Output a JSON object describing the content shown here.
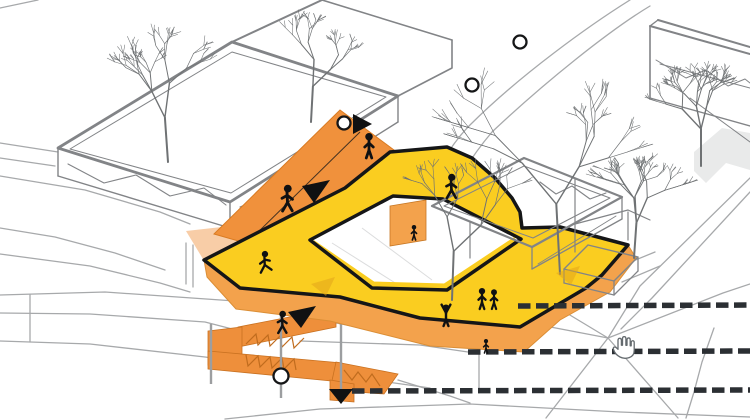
{
  "scene": {
    "type": "axonometric-architecture-diagram",
    "background": "#FFFFFF",
    "colors": {
      "platform_yellow": "#FACD20",
      "ramp_orange": "#F0913C",
      "apron_orange": "#F3A24C",
      "stair_orange": "#EE8F3B",
      "stair_detail": "#C06C1E",
      "outline_black": "#151617",
      "wireframe_gray": "#828487",
      "terrain_gray": "#A7A9AB",
      "tree_gray": "#6F7274",
      "dashed_line": "#2B2F33",
      "watermark_gray": "#E9EAEA",
      "figure_black": "#101112",
      "flow_arrow_yellow": "#E2A51B"
    }
  },
  "markers": {
    "circles": [
      {
        "name": "node-circle-top",
        "cx": 520,
        "cy": 42,
        "r": 6.5
      },
      {
        "name": "node-circle-upper",
        "cx": 472,
        "cy": 85,
        "r": 6.5
      },
      {
        "name": "node-circle-ramp-top",
        "cx": 344,
        "cy": 123,
        "r": 6.5
      },
      {
        "name": "node-circle-stairs",
        "cx": 281,
        "cy": 376,
        "r": 7.5
      }
    ],
    "route_arrows": [
      {
        "name": "route-arrow-ramp-top",
        "points": "353,114 372,124 353,134"
      },
      {
        "name": "route-arrow-ramp-up",
        "points": "330,180 302,186 314,203"
      },
      {
        "name": "route-arrow-stairs-up",
        "points": "316,306 288,312 301,328"
      },
      {
        "name": "route-arrow-down-exit",
        "points": "329,389 353,389 341,404"
      }
    ],
    "flow_arrows": [
      {
        "name": "flow-arrow-platform-left",
        "points": "335,277 311,284 326,296"
      },
      {
        "name": "flow-arrow-platform-right",
        "points": "580,266 556,273 571,285"
      }
    ],
    "dashed_lines": [
      {
        "name": "section-dashed-line-1",
        "x1": 518,
        "y1": 306,
        "x2": 750,
        "y2": 305
      },
      {
        "name": "section-dashed-line-2",
        "x1": 468,
        "y1": 352,
        "x2": 750,
        "y2": 351
      },
      {
        "name": "section-dashed-line-3",
        "x1": 352,
        "y1": 391,
        "x2": 750,
        "y2": 390
      }
    ],
    "figures": [
      {
        "type": "stand",
        "x": 369,
        "y": 158,
        "h": 25,
        "name": "person-ramp-top"
      },
      {
        "type": "walk",
        "x": 287,
        "y": 211,
        "h": 26,
        "name": "person-ramp-walking"
      },
      {
        "type": "run",
        "x": 266,
        "y": 272,
        "h": 21,
        "name": "person-running-platform"
      },
      {
        "type": "walk",
        "x": 451,
        "y": 198,
        "h": 24,
        "name": "person-upper-walkway"
      },
      {
        "type": "stand",
        "x": 414,
        "y": 240,
        "h": 15,
        "name": "person-courtyard-panel"
      },
      {
        "type": "pair",
        "x": 488,
        "y": 309,
        "h": 21,
        "name": "people-pair-platform"
      },
      {
        "type": "cheer",
        "x": 446,
        "y": 326,
        "h": 22,
        "name": "person-cheering-platform"
      },
      {
        "type": "stand",
        "x": 486,
        "y": 353,
        "h": 14,
        "name": "person-apron-edge"
      },
      {
        "type": "walk",
        "x": 282,
        "y": 333,
        "h": 22,
        "name": "person-stairs-walking"
      }
    ],
    "cursor": {
      "name": "hand-cursor",
      "x": 610,
      "y": 336
    }
  },
  "trees": {
    "background": [
      {
        "x": 168,
        "y": 162,
        "h": 135,
        "seed": 11,
        "lean": -4
      },
      {
        "x": 311,
        "y": 122,
        "h": 108,
        "seed": 7,
        "lean": 3
      },
      {
        "x": 701,
        "y": 166,
        "h": 112,
        "seed": 13,
        "lean": 0
      }
    ],
    "foreground": [
      {
        "x": 452,
        "y": 300,
        "h": 148,
        "seed": 3,
        "lean": 2
      },
      {
        "x": 560,
        "y": 274,
        "h": 212,
        "seed": 21,
        "lean": -3
      },
      {
        "x": 634,
        "y": 258,
        "h": 106,
        "seed": 5,
        "lean": 4
      }
    ]
  }
}
